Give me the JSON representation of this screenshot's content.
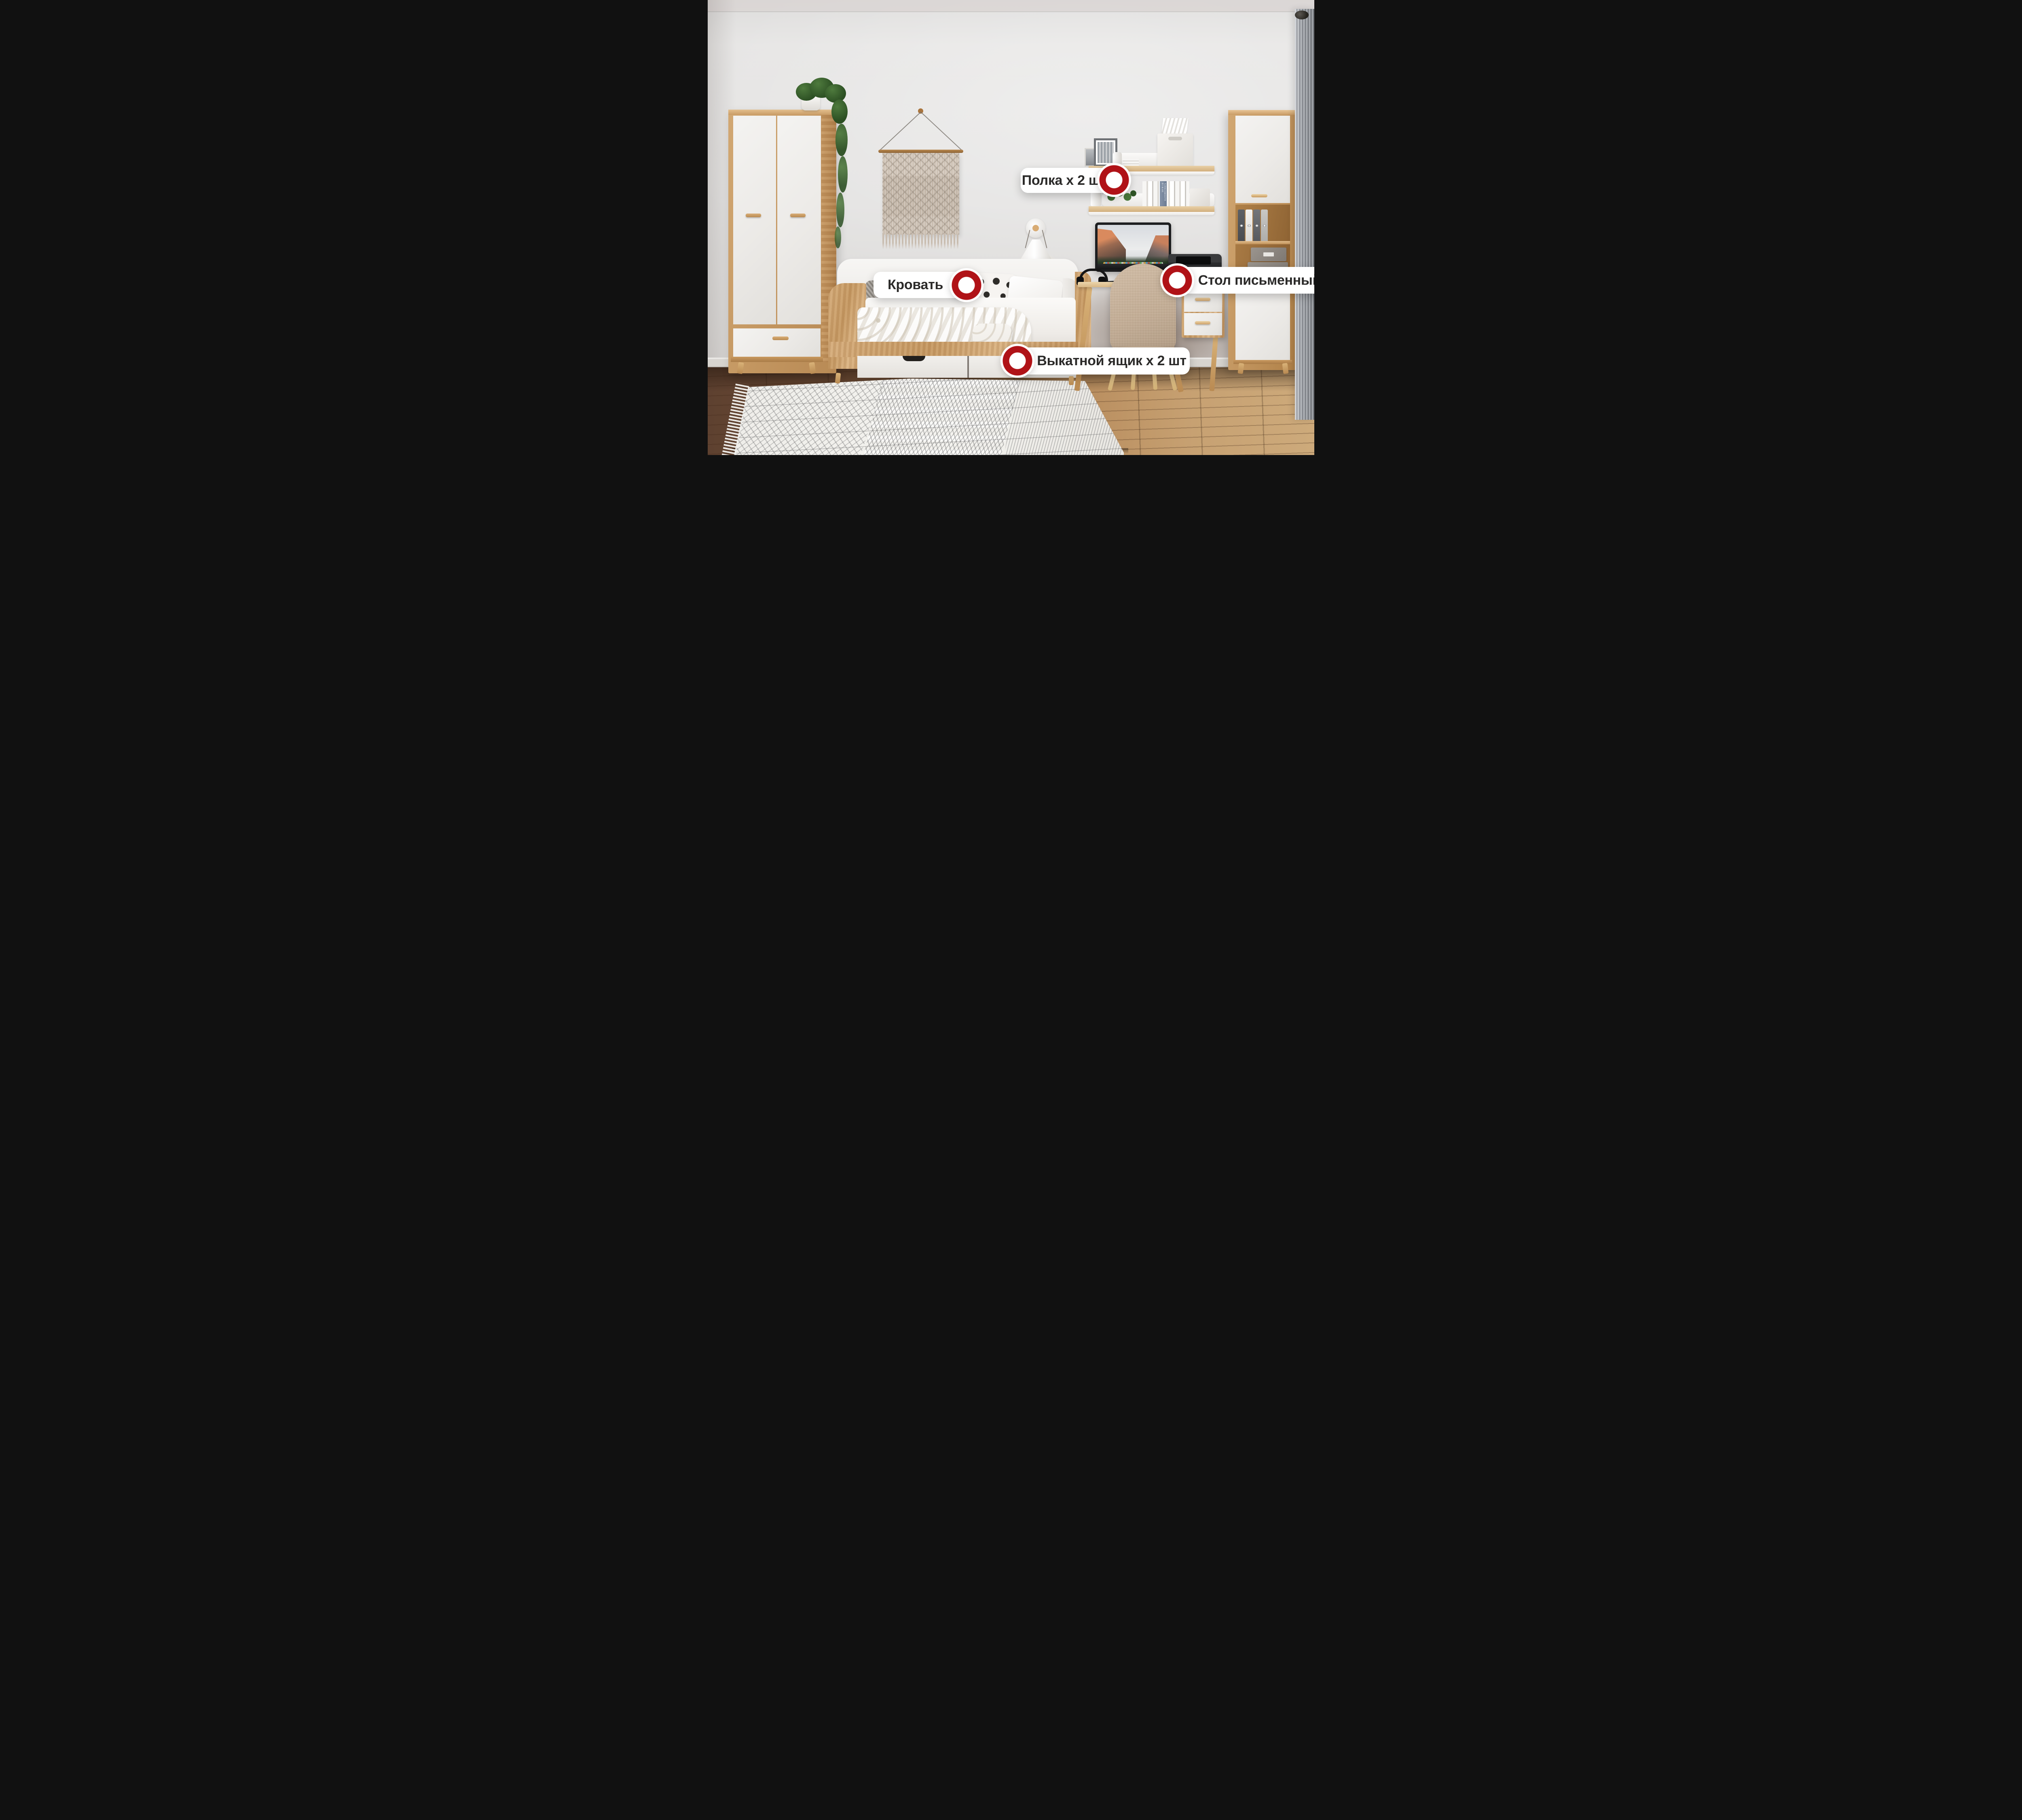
{
  "scene": {
    "description": "annotated kids-room furniture photo",
    "accent_red": "#B01217",
    "label_text_color": "#2B2A29",
    "wall_color": "#E3E2E1",
    "wood_color": "#C79A63",
    "floor_dark": "#5E4130",
    "floor_light": "#CDAA7B",
    "curtain_color": "#8E9298",
    "chair_color": "#C4AC92"
  },
  "annotations": [
    {
      "id": "shelf",
      "label": "Полка x 2 шт",
      "marker_side": "right"
    },
    {
      "id": "bed",
      "label": "Кровать",
      "marker_side": "right"
    },
    {
      "id": "desk",
      "label": "Стол письменный",
      "marker_side": "left"
    },
    {
      "id": "drawer",
      "label": "Выкатной ящик x 2 шт",
      "marker_side": "left"
    }
  ],
  "photo_texts": {
    "printer_brand": "Canon",
    "pillow_text": "I LOVE YOU TO THE MOON & BACK",
    "book_spine": "TURBOSMOOTH BY M.AX"
  }
}
